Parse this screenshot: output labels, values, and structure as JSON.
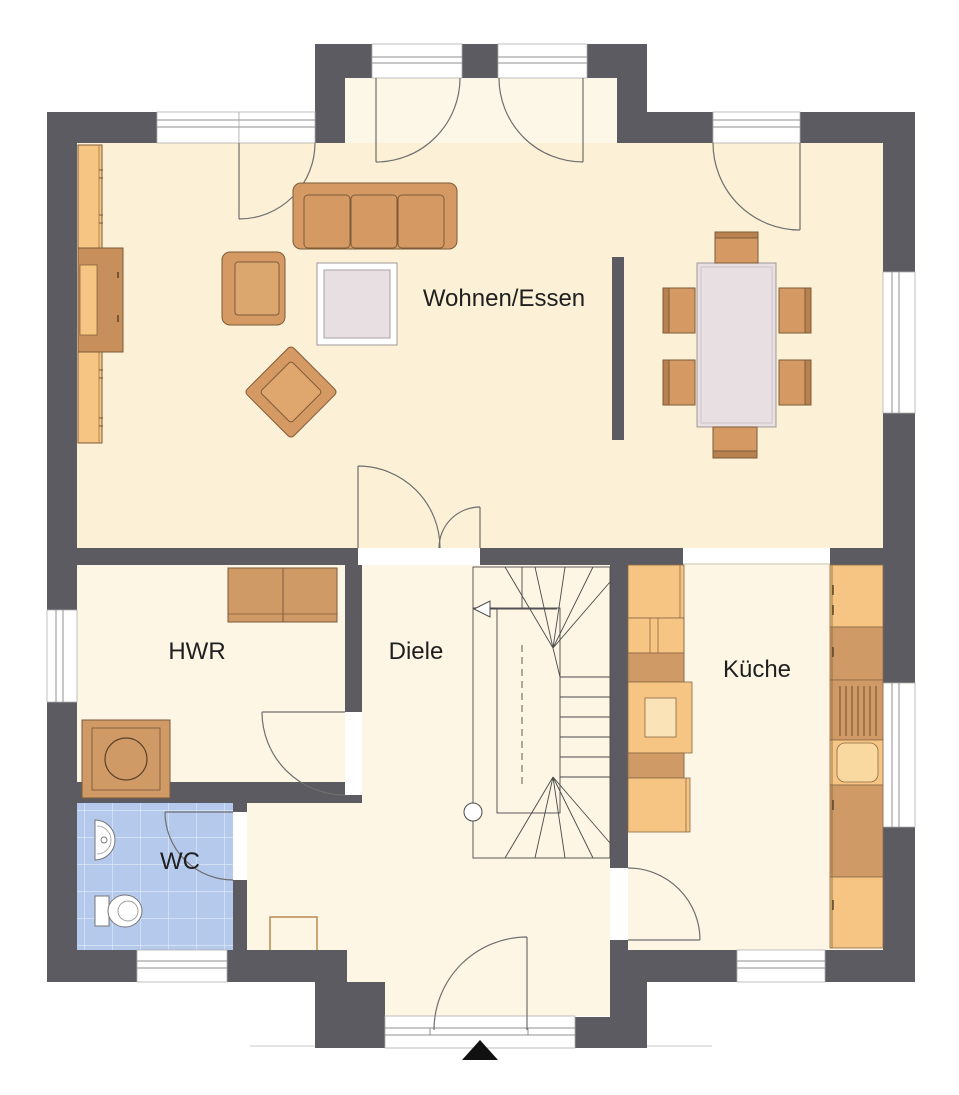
{
  "plan": {
    "type": "architectural-floor-plan",
    "style": "german residential ground floor",
    "entrance_marker": "black triangle at main entrance (bottom center)"
  },
  "rooms": {
    "living": {
      "label": "Wohnen/Essen"
    },
    "utility": {
      "label": "HWR"
    },
    "hall": {
      "label": "Diele"
    },
    "kitchen": {
      "label": "Küche"
    },
    "wc": {
      "label": "WC"
    }
  },
  "colors": {
    "wall": "#5b5b61",
    "floor_living": "#fcf1d6",
    "floor_bay": "#fdf7e8",
    "floor_secondary": "#fdf6e5",
    "wc_tile": "#b4c9ec",
    "wc_tile_line": "#dde7f8",
    "furniture_light": "#f6c583",
    "furniture_mid": "#d59a64",
    "furniture_dark": "#c68f5b",
    "furniture_accent": "#cf9a66",
    "furniture_outline": "#7d5b39",
    "table_top": "#e7dfe1",
    "table_border": "#9f969a",
    "window_white": "#ffffff",
    "door_arc": "#6f6f6f",
    "label_text": "#1f1f1f",
    "background": "#ffffff"
  },
  "furniture": [
    "sofa-3-seat",
    "armchair",
    "lounge-chair-diagonal",
    "coffee-table",
    "sideboard-long",
    "tv-lowboard",
    "room-divider-wall",
    "dining-table",
    "dining-chairs-x6",
    "kitchen-counter-left",
    "kitchen-island-hob",
    "kitchen-counter-right",
    "kitchen-sink",
    "kitchen-cooktop-lines",
    "hwr-cabinet",
    "washing-machine",
    "wc-hand-basin",
    "toilet",
    "doormat",
    "winder-staircase",
    "stair-up-arrow",
    "stair-start-circle"
  ]
}
